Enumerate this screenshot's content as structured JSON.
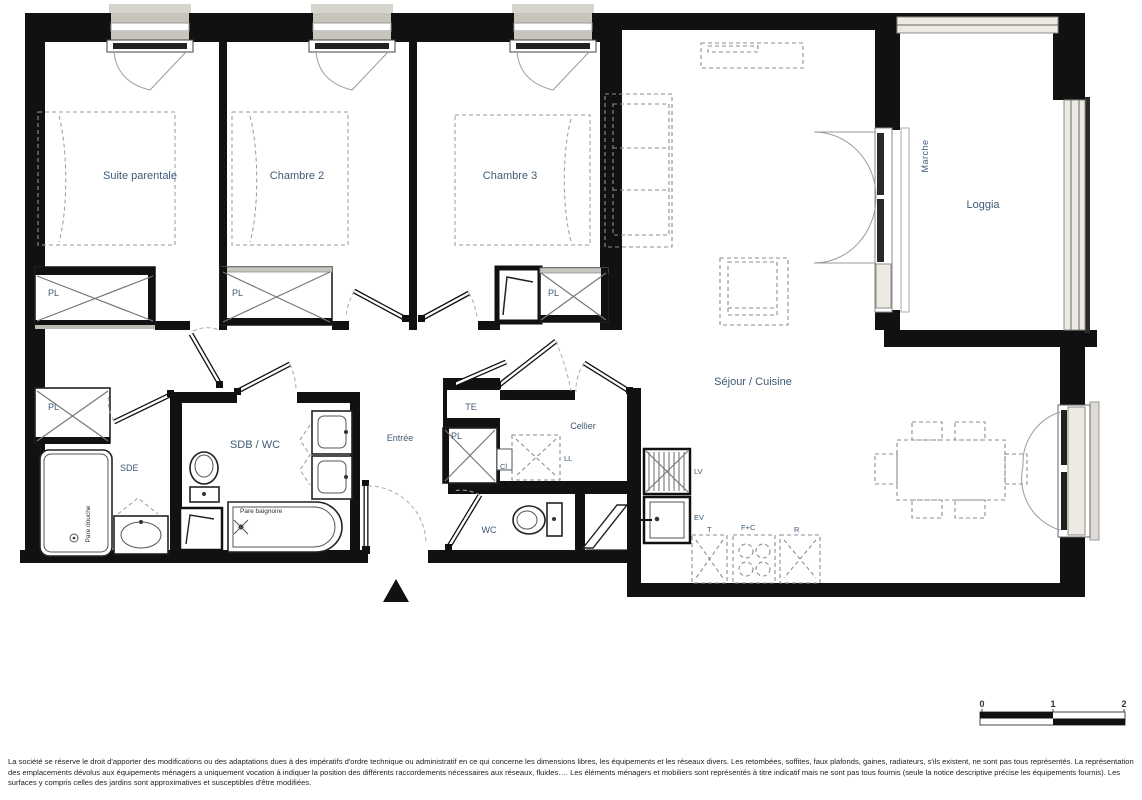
{
  "plan": {
    "labels": {
      "suite_parentale": "Suite parentale",
      "chambre_2": "Chambre 2",
      "chambre_3": "Chambre 3",
      "pl": "PL",
      "te": "TE",
      "sde": "SDE",
      "sdb_wc": "SDB / WC",
      "entree": "Entrée",
      "cellier": "Cellier",
      "wc": "WC",
      "sejour_cuisine": "Séjour / Cuisine",
      "loggia": "Loggia",
      "marche": "Marche",
      "ll": "LL",
      "cl": "Cl",
      "lv": "LV",
      "ev": "EV",
      "t": "T",
      "f_c": "F+C",
      "r": "R",
      "pare_douche": "Pare douche",
      "pare_baignoire": "Pare baignoire"
    },
    "scale_bar": {
      "t0": "0",
      "t1": "1",
      "t2": "2"
    },
    "disclaimer": "La société se réserve le droit d'apporter des modifications ou des adaptations dues à des impératifs d'ordre technique ou administratif en ce qui concerne les dimensions libres, les équipements et les réseaux divers. Les retombées, soffites, faux plafonds, gaines, radiateurs, s'ils existent, ne sont pas tous représentés. La représentation des emplacements dévolus aux équipements ménagers a uniquement vocation à indiquer la position des différents raccordements nécessaires aux réseaux, fluides…. Les éléments ménagers et mobiliers sont représentés à titre indicatif mais ne sont pas tous fournis (seule la notice descriptive précise les équipements fournis). Les surfaces y compris celles des jardins sont approximatives et susceptibles d'être modifiées.",
    "colors": {
      "wall": "#111111",
      "label": "#3d5a76",
      "glazing": "#eceae3"
    }
  }
}
